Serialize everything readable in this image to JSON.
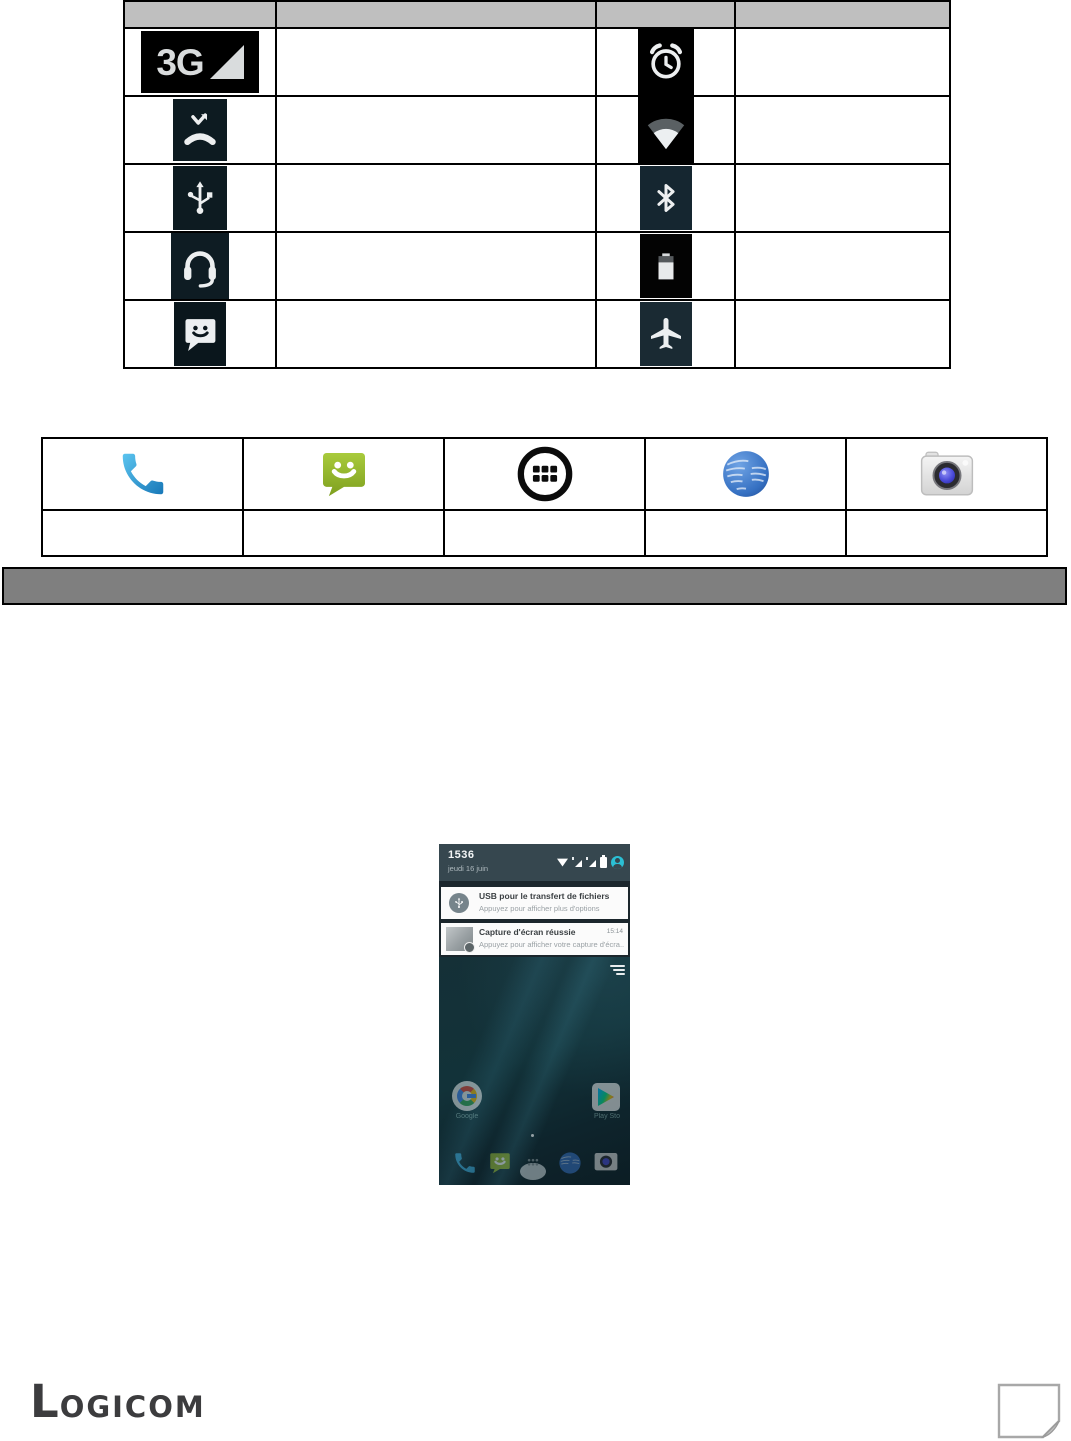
{
  "colors": {
    "table_header_bg": "#BFBFBF",
    "banner_bg": "#7F7F7F",
    "statusbar_bg": "#36474F",
    "notification_shade_bg": "#1B262C",
    "profile_accent": "#2BBFD4",
    "messaging_green": "#8FB02C",
    "phone_blue": "#2D9FD8"
  },
  "status_icons_table": {
    "three_g_label": "3G",
    "rows": [
      {
        "left_icon": "3g-signal-icon",
        "left_description": "",
        "right_icon": "alarm-clock-icon",
        "right_description": ""
      },
      {
        "left_icon": "missed-call-icon",
        "left_description": "",
        "right_icon": "wifi-icon",
        "right_description": ""
      },
      {
        "left_icon": "usb-icon",
        "left_description": "",
        "right_icon": "bluetooth-icon",
        "right_description": ""
      },
      {
        "left_icon": "headset-icon",
        "left_description": "",
        "right_icon": "battery-icon",
        "right_description": ""
      },
      {
        "left_icon": "sms-icon",
        "left_description": "",
        "right_icon": "airplane-mode-icon",
        "right_description": ""
      }
    ]
  },
  "app_icons_table": {
    "icons": [
      "phone-icon",
      "messaging-icon",
      "app-drawer-icon",
      "browser-icon",
      "camera-icon"
    ],
    "labels": [
      "",
      "",
      "",
      "",
      ""
    ]
  },
  "divider_banner": {
    "label": ""
  },
  "phone_screenshot": {
    "status_bar": {
      "time": "1536",
      "date": "jeudi 16 juin",
      "icons": [
        "wifi-icon",
        "signal-sim1-icon",
        "signal-sim2-icon",
        "battery-icon",
        "profile-icon"
      ]
    },
    "notifications": [
      {
        "icon": "usb-icon",
        "title": "USB pour le transfert de fichiers",
        "subtitle": "Appuyez pour afficher plus d'options"
      },
      {
        "icon": "screenshot-thumbnail",
        "title": "Capture d'écran réussie",
        "time": "15:14",
        "subtitle": "Appuyez pour afficher votre capture d'écra.."
      }
    ],
    "home": {
      "labels": [
        "Google",
        "Play Sto"
      ],
      "dock_icons": [
        "phone-icon",
        "messaging-icon",
        "app-drawer-icon",
        "browser-icon",
        "camera-icon"
      ]
    }
  },
  "footer": {
    "logo_first": "L",
    "logo_rest": "OGICOM"
  }
}
